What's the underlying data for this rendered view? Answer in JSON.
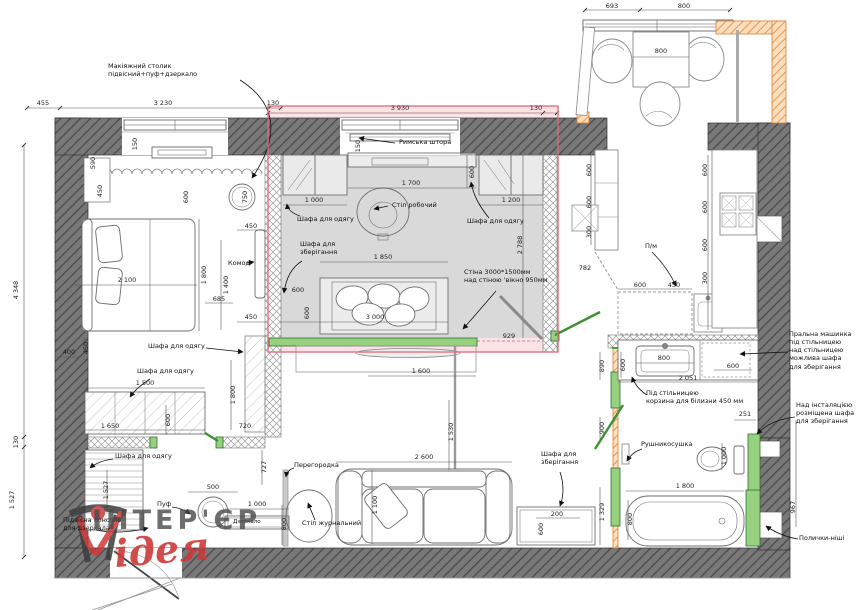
{
  "watermark": {
    "brand": "ІНТЕР'ЄР",
    "sub": "ідея"
  },
  "labels": {
    "makeup": "Макіяжний столик\nпідвісний+пуф+дзеркало",
    "roman_blind": "Римська штора",
    "desk": "Стіл робочий",
    "wardrobe_study_left": "Шафа для одягу",
    "wardrobe_study_right": "Шафа для одягу",
    "storage_study": "Шафа для\nзберігання",
    "wall_note": "Стіна 3000*1500мм\nнад стіною 'вікно 950мм",
    "komod": "Комод",
    "wardrobe_bedroom": "Шафа для одягу",
    "wardrobe_hall_top": "Шафа для одягу",
    "wardrobe_hall_bottom": "Шафа для одягу",
    "partition": "Перегородка",
    "pouf": "Пуф",
    "mirror": "Дзеркало",
    "console_note": "Підвісна консоль\nдля дзеркала",
    "coffee_table": "Стіл журнальний",
    "storage_living": "Шафа для\nзберігання",
    "dishwasher": "П/м",
    "washer_note": "Пральна машинка\nпід стільницею\nнад стільницею\nможлива шафа\nдля зберігання",
    "laundry_note": "Під стільницею\nкорзина для білизни 450 мм",
    "inst_note": "Над інсталяцією\nрозміщена шафа\nдля зберігання",
    "towel": "Рушникосушка",
    "niche": "Полички-ніші"
  },
  "dims": {
    "t455": "455",
    "t3230": "3 230",
    "t130a": "130",
    "t3930": "3 930",
    "t130b": "130",
    "t693": "693",
    "t800a": "800",
    "t800b": "800",
    "t4348": "4 348",
    "t130c": "130",
    "t1527a": "1 527",
    "t590": "590",
    "t150a": "150",
    "t450a": "450",
    "t600a": "600",
    "t750": "750",
    "t2100": "2 100",
    "t1800a": "1 800",
    "t1400": "1 400",
    "t685": "685",
    "t450b": "450",
    "t450c": "450",
    "t400": "400",
    "t450d": "450",
    "t150b": "150",
    "t600b": "600",
    "t1700": "1 700",
    "t1000a": "1 000",
    "t1200": "1 200",
    "t2788": "2 788",
    "t1850": "1 850",
    "t600c": "600",
    "t600d": "600",
    "t3000": "3 000",
    "t929": "929",
    "t1600": "1 600",
    "t1500": "1 500",
    "t1650": "1 650",
    "t600e": "600",
    "t720": "720",
    "t1800b": "1 800",
    "t727": "727",
    "t1527b": "1 527",
    "t500": "500",
    "t1000b": "1 000",
    "t800c": "800",
    "t2600": "2 600",
    "t1100": "1 100",
    "t1530": "1 530",
    "t200": "200",
    "t600f": "600",
    "t782": "782",
    "t600g": "600",
    "t600h": "600",
    "t300a": "300",
    "t600j": "600",
    "t600k": "600",
    "t600l": "600",
    "t300b": "300",
    "t600m": "600",
    "t450e": "450",
    "t890": "890",
    "t600n": "600",
    "t800d": "800",
    "t600o": "600",
    "t2051": "2 051",
    "t900": "900",
    "t251": "251",
    "t1000c": "1 000",
    "t1800c": "1 800",
    "t800e": "800",
    "t1329": "1 329",
    "t967": "967"
  }
}
